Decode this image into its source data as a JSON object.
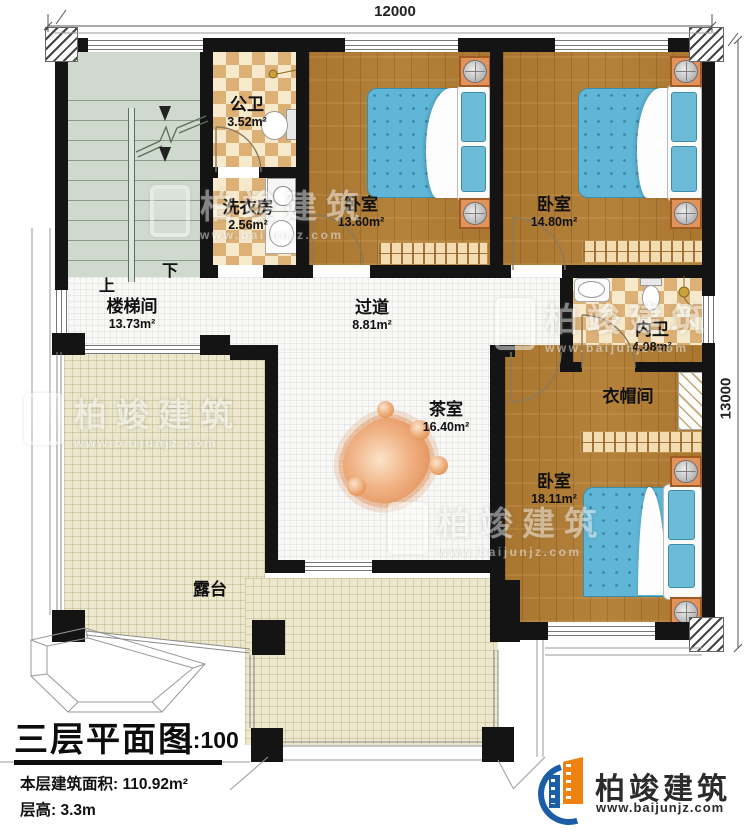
{
  "plan": {
    "dimensions": {
      "top": "12000",
      "right": "13000"
    },
    "stairs": {
      "up": "上",
      "down": "下"
    },
    "rooms": {
      "stairwell": {
        "name": "楼梯间",
        "area": "13.73m²"
      },
      "public_bath": {
        "name": "公卫",
        "area": "3.52m²"
      },
      "laundry": {
        "name": "洗衣房",
        "area": "2.56m²"
      },
      "bedroom1": {
        "name": "卧室",
        "area": "13.60m²"
      },
      "bedroom2": {
        "name": "卧室",
        "area": "14.80m²"
      },
      "corridor": {
        "name": "过道",
        "area": "8.81m²"
      },
      "inner_bath": {
        "name": "内卫",
        "area": "4.08m²"
      },
      "cloakroom": {
        "name": "衣帽间"
      },
      "tea_room": {
        "name": "茶室",
        "area": "16.40m²"
      },
      "bedroom3": {
        "name": "卧室",
        "area": "18.11m²"
      },
      "terrace": {
        "name": "露台"
      }
    }
  },
  "title_block": {
    "title": "三层平面图",
    "scale": "1:100",
    "floor_area": "本层建筑面积: 110.92m²",
    "floor_height": "层高: 3.3m"
  },
  "logo": {
    "name": "柏竣建筑",
    "url": "www.baijunjz.com"
  },
  "watermark": {
    "name": "柏竣建筑",
    "url": "www.baijunjz.com"
  },
  "colors": {
    "wall": "#141414",
    "wood_floor": "#ab7832",
    "tile_dark": "#ddb176",
    "tile_light": "#f6e9cc",
    "terrace_tile": "#ece7cd",
    "stair_floor": "#cfd9cd",
    "bed_blue": "#5fb6d6",
    "accent_orange": "#e08a4e",
    "logo_blue": "#1b5ea6",
    "logo_orange": "#ef8111"
  }
}
